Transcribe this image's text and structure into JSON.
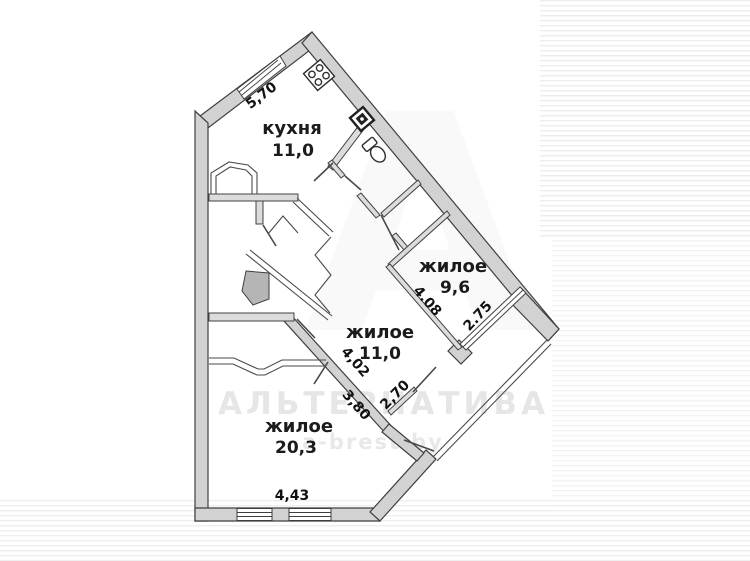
{
  "title": "apartment-floor-plan",
  "rooms": {
    "kitchen": {
      "name": "кухня",
      "area": "11,0"
    },
    "living_small": {
      "name": "жилое",
      "area": "9,6"
    },
    "living_mid": {
      "name": "жилое",
      "area": "11,0"
    },
    "living_large": {
      "name": "жилое",
      "area": "20,3"
    }
  },
  "dimensions": {
    "kitchen_window_wall": "5,70",
    "living_small_length": "4.08",
    "living_small_window": "2.75",
    "living_mid_length": "4,02",
    "living_mid_balcony": "2,70",
    "living_large_length": "3,80",
    "living_large_window": "4,43"
  },
  "watermark": {
    "title": "АЛЬТЕРНАТИВА",
    "site": "a-brest.by",
    "letter": "А"
  },
  "icons": {
    "stove": "stove-icon",
    "electric_panel": "electric-panel-icon",
    "toilet": "toilet-icon"
  },
  "colors": {
    "wall_fill": "#d2d2d2",
    "wall_stroke": "#3f3f3f",
    "label_text": "#1b1b1b",
    "watermark": "#8a8a8a",
    "background": "#ffffff"
  }
}
